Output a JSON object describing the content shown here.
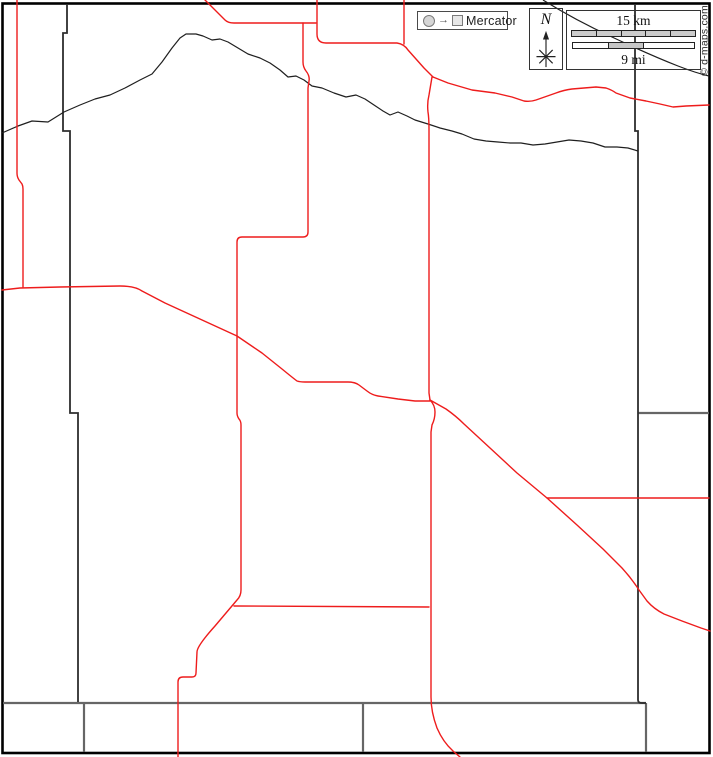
{
  "map": {
    "projection_label": "Mercator",
    "projection_arrow_glyph": "→",
    "compass": {
      "north_label": "N"
    },
    "scale": {
      "km_label": "15 km",
      "mi_label": "9 mi"
    },
    "copyright": "© d-maps.com",
    "colors": {
      "road": "#ee1c1c",
      "boundary": "#2e2e2e",
      "section_line": "#666666",
      "border": "#000000",
      "river": "#1f1f1f",
      "scale_bar_fill": "#cccccc"
    }
  }
}
